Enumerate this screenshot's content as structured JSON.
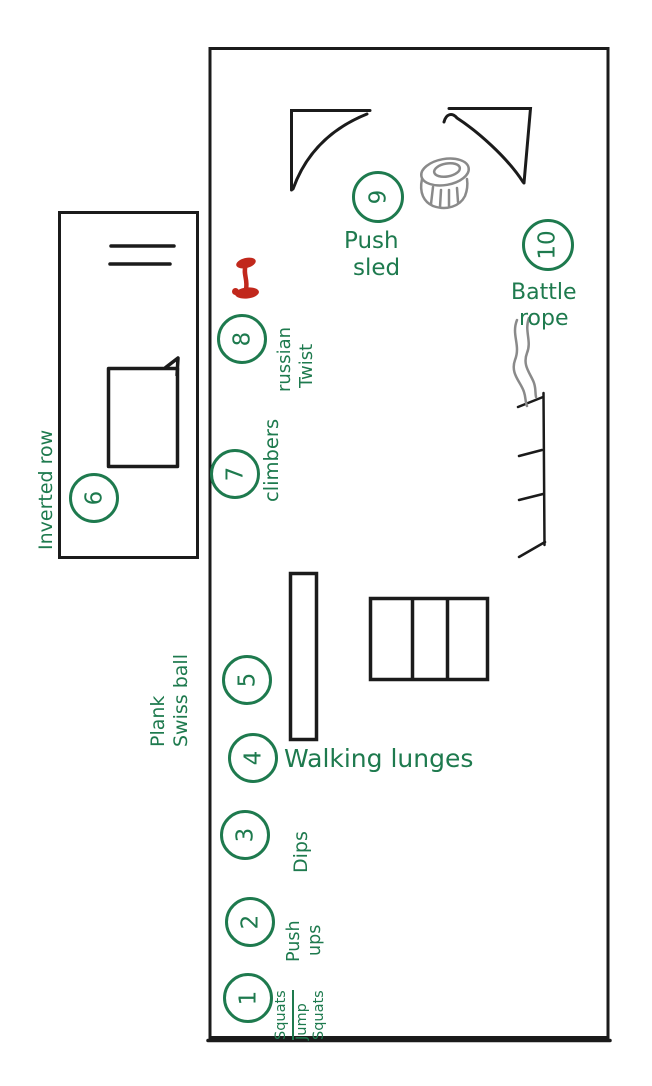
{
  "canvas": {
    "background": "#ffffff",
    "description": "Hand-drawn gym circuit floor plan with numbered exercise stations"
  },
  "colors": {
    "ink": "#1b1b1b",
    "marker_green": "#1e7a4e",
    "marker_red": "#c1281c",
    "marker_gray": "#8a8a8a"
  },
  "stations": [
    {
      "number": "1",
      "label": "Squats / Jump Squats",
      "lines": [
        "Squats",
        "Jump",
        "Squats"
      ]
    },
    {
      "number": "2",
      "label": "Push ups",
      "lines": [
        "Push",
        "ups"
      ]
    },
    {
      "number": "3",
      "label": "Dips",
      "lines": [
        "Dips"
      ]
    },
    {
      "number": "4",
      "label": "Walking lunges",
      "lines": [
        "Walking lunges"
      ]
    },
    {
      "number": "5",
      "label": "Plank Swiss ball",
      "lines": [
        "Plank",
        "Swiss ball"
      ]
    },
    {
      "number": "6",
      "label": "Inverted row",
      "lines": [
        "Inverted row"
      ]
    },
    {
      "number": "7",
      "label": "Climbers",
      "lines": [
        "climbers"
      ]
    },
    {
      "number": "8",
      "label": "Russian Twist",
      "lines": [
        "russian",
        "Twist"
      ]
    },
    {
      "number": "9",
      "label": "Push sled",
      "lines": [
        "Push",
        "sled"
      ]
    },
    {
      "number": "10",
      "label": "Battle rope",
      "lines": [
        "Battle",
        "rope"
      ]
    }
  ],
  "equipment_icons": [
    {
      "name": "dumbbell-icon",
      "color": "#c1281c"
    },
    {
      "name": "tire-icon",
      "color": "#8a8a8a"
    },
    {
      "name": "battle-rope-icon",
      "color": "#8a8a8a"
    },
    {
      "name": "wall-ladder-icon",
      "color": "#1b1b1b"
    },
    {
      "name": "bench-icon",
      "color": "#1b1b1b"
    },
    {
      "name": "exercise-mat",
      "color": "#1b1b1b"
    },
    {
      "name": "storage-rack",
      "color": "#1b1b1b"
    }
  ]
}
